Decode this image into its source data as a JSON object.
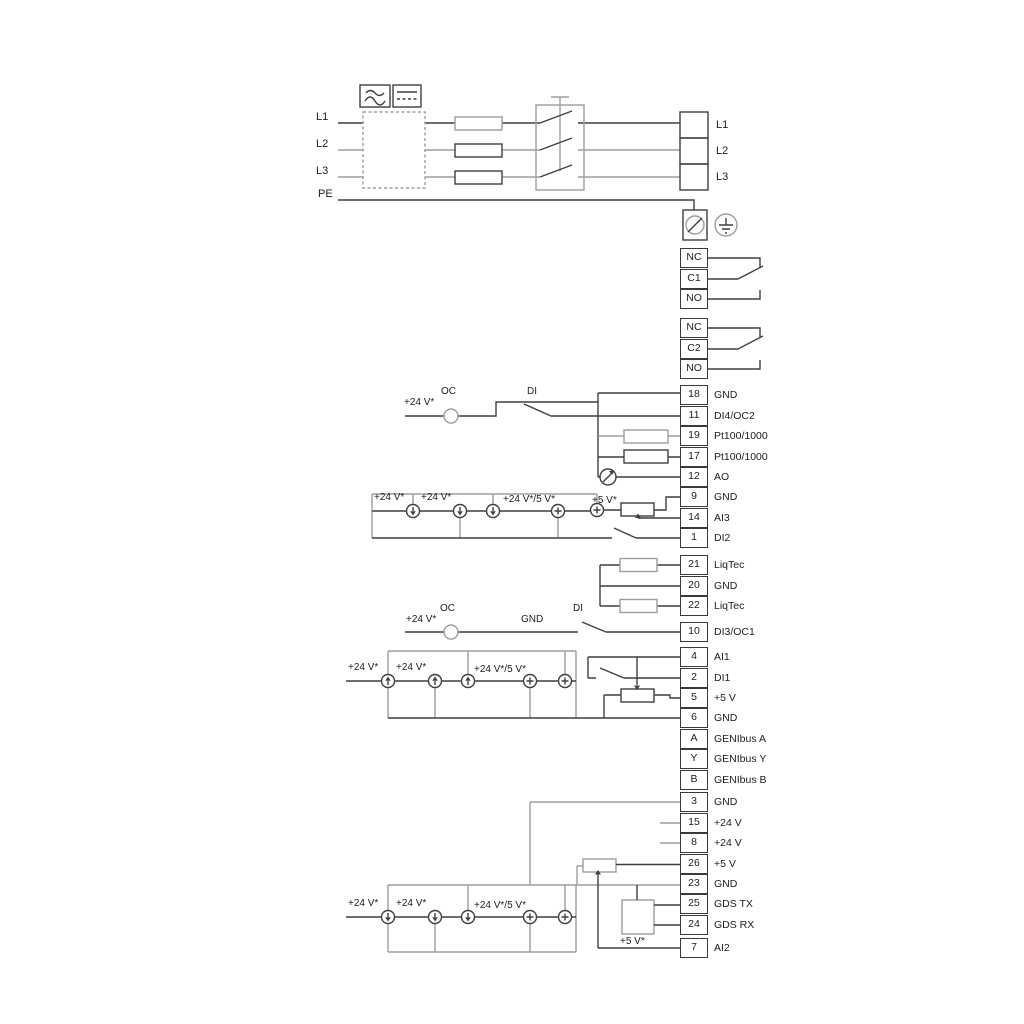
{
  "diagram_type": "pump-drive-wiring-diagram",
  "colors": {
    "wire_dark": "#3f3f3f",
    "wire_gray": "#9d9d9d",
    "background": "#ffffff"
  },
  "mains": {
    "left_labels": {
      "l1": "L1",
      "l2": "L2",
      "l3": "L3",
      "pe": "PE"
    },
    "right_labels": {
      "l1": "L1",
      "l2": "L2",
      "l3": "L3"
    }
  },
  "relay1": {
    "rows": [
      "NC",
      "C1",
      "NO"
    ]
  },
  "relay2": {
    "rows": [
      "NC",
      "C2",
      "NO"
    ]
  },
  "strips": {
    "a": {
      "rows": [
        [
          "18",
          "GND"
        ],
        [
          "11",
          "DI4/OC2"
        ],
        [
          "19",
          "Pt100/1000"
        ],
        [
          "17",
          "Pt100/1000"
        ],
        [
          "12",
          "AO"
        ],
        [
          "9",
          "GND"
        ],
        [
          "14",
          "AI3"
        ],
        [
          "1",
          "DI2"
        ]
      ]
    },
    "b": {
      "rows": [
        [
          "21",
          "LiqTec"
        ],
        [
          "20",
          "GND"
        ],
        [
          "22",
          "LiqTec"
        ]
      ]
    },
    "c": {
      "rows": [
        [
          "10",
          "DI3/OC1"
        ]
      ]
    },
    "d": {
      "rows": [
        [
          "4",
          "AI1"
        ],
        [
          "2",
          "DI1"
        ],
        [
          "5",
          "+5 V"
        ],
        [
          "6",
          "GND"
        ],
        [
          "A",
          "GENIbus A"
        ],
        [
          "Y",
          "GENIbus Y"
        ],
        [
          "B",
          "GENIbus B"
        ]
      ]
    },
    "e": {
      "rows": [
        [
          "3",
          "GND"
        ],
        [
          "15",
          "+24 V"
        ],
        [
          "8",
          "+24 V"
        ],
        [
          "26",
          "+5 V"
        ],
        [
          "23",
          "GND"
        ],
        [
          "25",
          "GDS TX"
        ],
        [
          "24",
          "GDS RX"
        ]
      ]
    },
    "f": {
      "rows": [
        [
          "7",
          "AI2"
        ]
      ]
    }
  },
  "ann": {
    "p24": "+24 V*",
    "p24_5": "+24 V*/5 V*",
    "p5": "+5 V*",
    "oc": "OC",
    "di": "DI",
    "gnd": "GND"
  },
  "icons": {
    "ac_symbol": "sine-wave",
    "dc_symbol": "solid-over-dashed-line",
    "earth": "protective-earth",
    "meter": "analog-output-meter",
    "current_sink": "arrow-down-circle",
    "current_source_plus": "plus-circle"
  }
}
